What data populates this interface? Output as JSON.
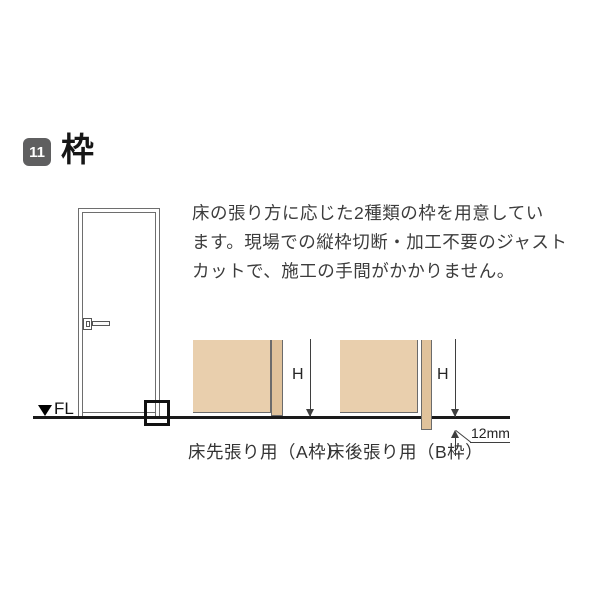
{
  "header": {
    "section_number": "11",
    "section_title": "枠"
  },
  "intro": {
    "lines": [
      "床の張り方に応じた2種類の枠を用意してい",
      "ます。現場での縦枠切断・加工不要のジャスト",
      "カットで、施工の手間がかかりません。"
    ]
  },
  "diagram": {
    "fl_label": "FL",
    "frames": [
      {
        "height_label": "H",
        "caption": "床先張り用（A枠）"
      },
      {
        "height_label": "H",
        "caption": "床後張り用（B枠）",
        "offset_label": "12mm"
      }
    ]
  },
  "colors": {
    "wall-fill": "#e9cfad",
    "frame-fill": "#e0c29b",
    "badge": "#5f5f60",
    "text": "#3c3c3c",
    "dim": "#3f3f3f",
    "door-line": "#6e6e6e"
  }
}
